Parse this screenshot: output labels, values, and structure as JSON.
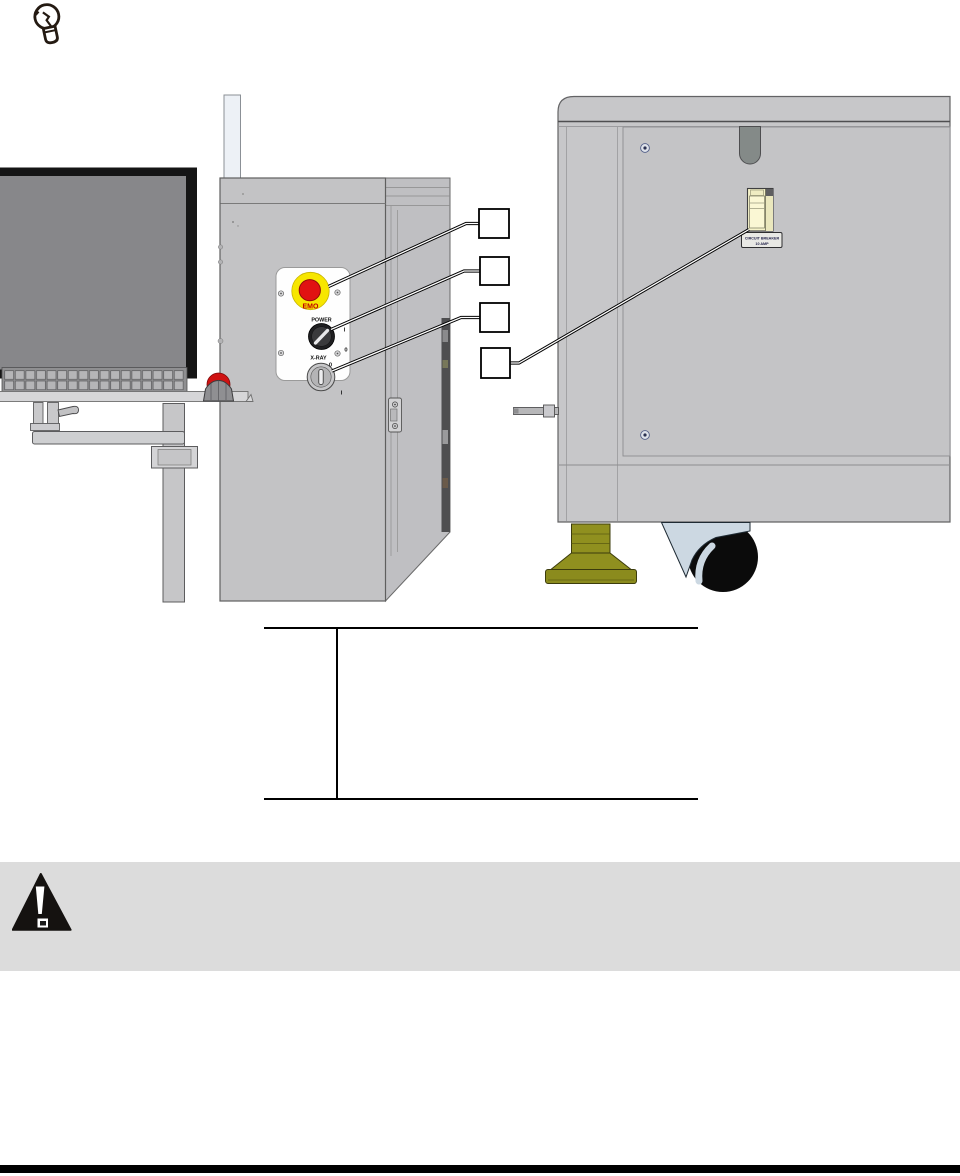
{
  "emo_panel": {
    "emo": "EMO",
    "power": "POWER",
    "power_on": "I",
    "power_off": "0",
    "xray": "X-RAY",
    "xray_off": "0",
    "xray_on": "I"
  },
  "breaker": {
    "line1": "CIRCUIT BREAKER",
    "line2": "10 AMP"
  },
  "callouts": {
    "box1": "",
    "box2": "",
    "box3": "",
    "box4": ""
  },
  "table": {
    "columns": 2,
    "rows": []
  },
  "warning": {
    "text": ""
  },
  "colors": {
    "emo_ring": "#f7e600",
    "emo_button": "#e11212",
    "emo_text": "#c00000",
    "breaker_body": "#f6f3c9",
    "foot_olive": "#90901f",
    "caster_bracket": "#ccd8e2",
    "trackball_red": "#cf1212",
    "machine_gray": "#c3c3c5",
    "screen_gray": "#87878a",
    "banner_bg": "#dcdcdc",
    "footer": "#000000"
  }
}
